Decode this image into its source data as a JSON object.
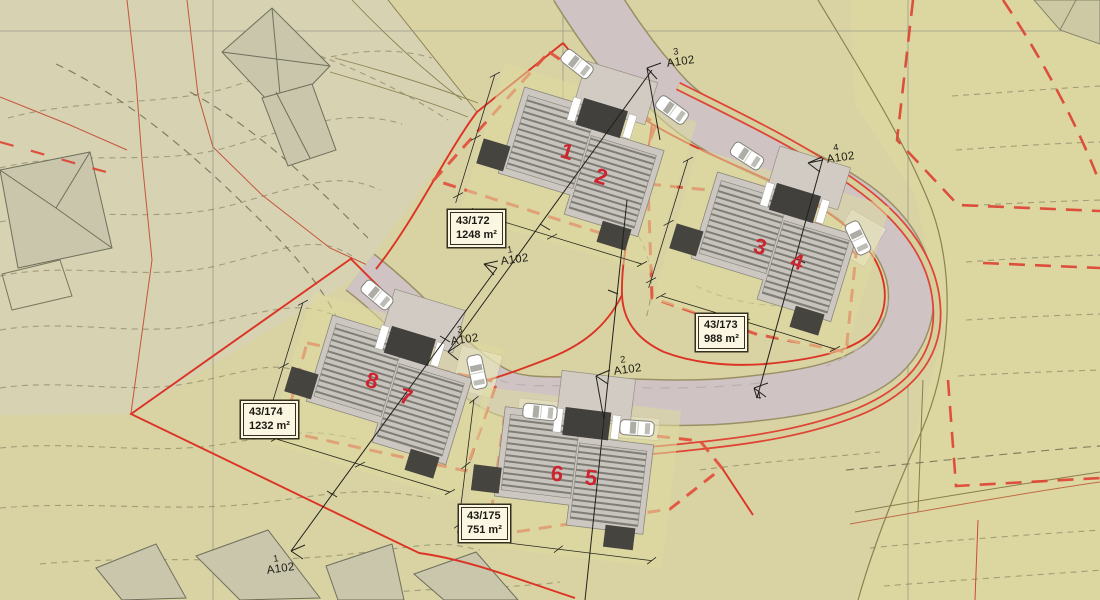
{
  "plan": {
    "parcels": [
      {
        "id": "43/172",
        "area": "1248 m²"
      },
      {
        "id": "43/173",
        "area": "988 m²"
      },
      {
        "id": "43/174",
        "area": "1232 m²"
      },
      {
        "id": "43/175",
        "area": "751 m²"
      }
    ],
    "houses": [
      {
        "label": "1"
      },
      {
        "label": "2"
      },
      {
        "label": "3"
      },
      {
        "label": "4"
      },
      {
        "label": "8"
      },
      {
        "label": "7"
      },
      {
        "label": "6"
      },
      {
        "label": "5"
      }
    ],
    "markers": [
      {
        "num": "3",
        "code": "A102"
      },
      {
        "num": "4",
        "code": "A102"
      },
      {
        "num": "1",
        "code": "A102"
      },
      {
        "num": "2",
        "code": "A102"
      },
      {
        "num": "3",
        "code": "A102"
      },
      {
        "num": "1",
        "code": "A102"
      },
      {
        "num": "4",
        "code": "A102"
      }
    ],
    "colors": {
      "background": "#d9d3a4",
      "upper_left_zone": "#d7d2b2",
      "road": "#cfc3c4",
      "sidewalk_strip": "#d6cf9e",
      "boundary_red": "#dc3424",
      "envelope_red": "#e2503c",
      "house_number_red": "#ce2430",
      "building_base": "#ccc8c1",
      "building_dark": "#42403c",
      "label_box_bg": "#fbf6e2",
      "contour": "#8f8a68",
      "existing_building": "#c9c6ab"
    }
  }
}
